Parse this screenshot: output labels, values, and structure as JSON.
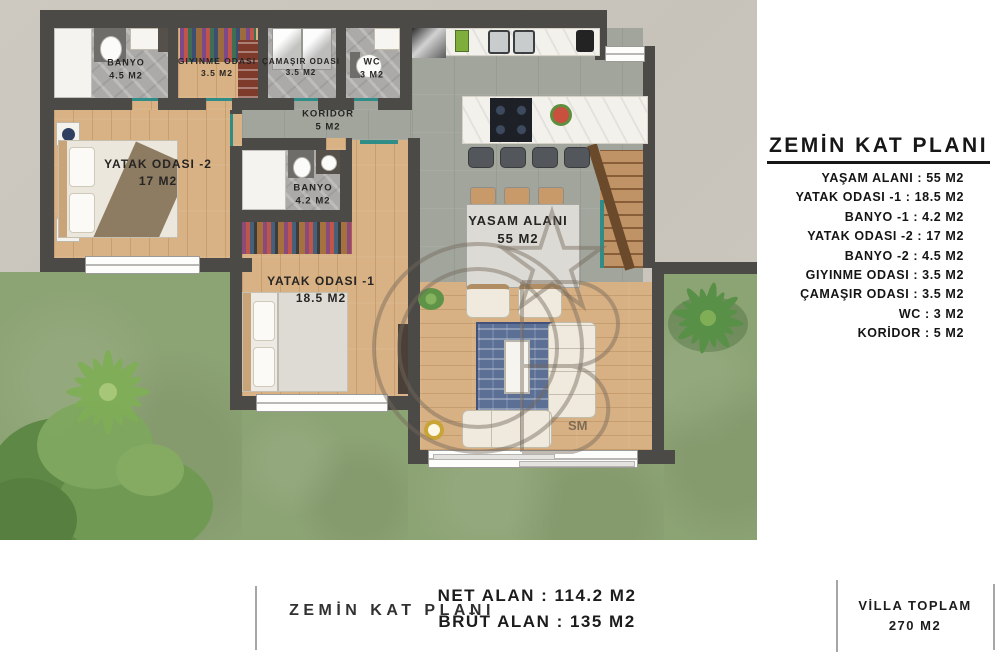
{
  "side_panel": {
    "title": "ZEMİN KAT PLANI",
    "lines": [
      "YAŞAM ALANI : 55 M2",
      "YATAK ODASI -1 : 18.5 M2",
      "BANYO -1 : 4.2 M2",
      "YATAK ODASI -2 : 17 M2",
      "BANYO -2 : 4.5 M2",
      "GIYINME ODASI : 3.5 M2",
      "ÇAMAŞIR ODASI : 3.5 M2",
      "WC : 3 M2",
      "KORİDOR : 5 M2"
    ]
  },
  "footer": {
    "plan_name": "ZEMİN KAT PLANI",
    "net": "NET ALAN : 114.2 M2",
    "brut": "BRÜT ALAN : 135 M2",
    "villa_label": "VİLLA TOPLAM",
    "villa_value": "270 M2"
  },
  "plan": {
    "labels": {
      "banyo1": {
        "name": "BANYO",
        "area": "4.5 M2"
      },
      "giyinme": {
        "name": "GIYINME ODASI",
        "area": "3.5 M2"
      },
      "camasir": {
        "name": "ÇAMAŞIR ODASI",
        "area": "3.5 M2"
      },
      "wc": {
        "name": "WC",
        "area": "3 M2"
      },
      "koridor": {
        "name": "KORIDOR",
        "area": "5 M2"
      },
      "yatak2": {
        "name": "YATAK ODASI -2",
        "area": "17 M2"
      },
      "banyo2": {
        "name": "BANYO",
        "area": "4.2 M2"
      },
      "yatak1": {
        "name": "YATAK ODASI -1",
        "area": "18.5 M2"
      },
      "yasam": {
        "name": "YASAM ALANI",
        "area": "55 M2"
      }
    },
    "watermark": "SM"
  },
  "colors": {
    "wall": "#4b4a47",
    "lawn": "#8ca374",
    "pavement": "#c9c5bd",
    "wood_floor": "#d8b184",
    "accent_teal": "#2f8c86"
  }
}
